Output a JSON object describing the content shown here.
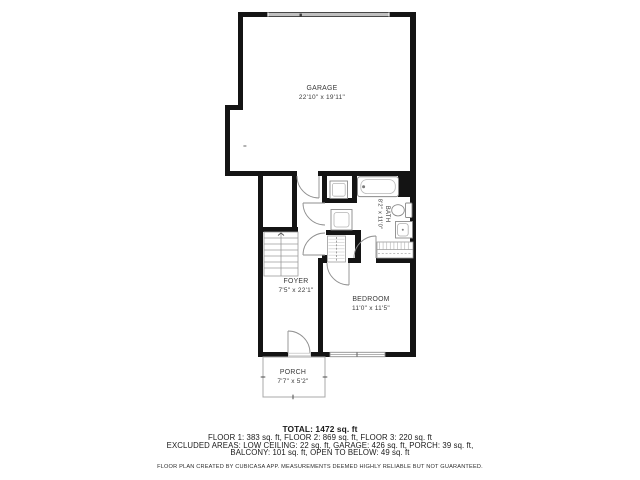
{
  "plan": {
    "rooms": {
      "garage": {
        "name": "GARAGE",
        "dims": "22'10\" x 19'11\""
      },
      "bath": {
        "name": "BATH",
        "dims": "8'2\" x 11'0\""
      },
      "foyer": {
        "name": "FOYER",
        "dims": "7'5\" x 22'1\""
      },
      "bedroom": {
        "name": "BEDROOM",
        "dims": "11'0\" x 11'5\""
      },
      "porch": {
        "name": "PORCH",
        "dims": "7'7\" x 5'2\""
      }
    },
    "colors": {
      "wall": "#141414",
      "fixture_line": "#8f8f8f",
      "label_text": "#3a3a3a",
      "garage_door": "#c0c0c0"
    }
  },
  "summary": {
    "total": "TOTAL: 1472 sq. ft",
    "floors": "FLOOR 1: 383 sq. ft, FLOOR 2: 869 sq. ft, FLOOR 3: 220 sq. ft",
    "excluded_1": "EXCLUDED AREAS: LOW CEILING: 22 sq. ft, GARAGE: 426 sq. ft, PORCH: 39 sq. ft,",
    "excluded_2": "BALCONY: 101 sq. ft, OPEN TO BELOW: 49 sq. ft",
    "disclaimer": "FLOOR PLAN CREATED BY CUBICASA APP. MEASUREMENTS DEEMED HIGHLY RELIABLE BUT NOT GUARANTEED."
  }
}
